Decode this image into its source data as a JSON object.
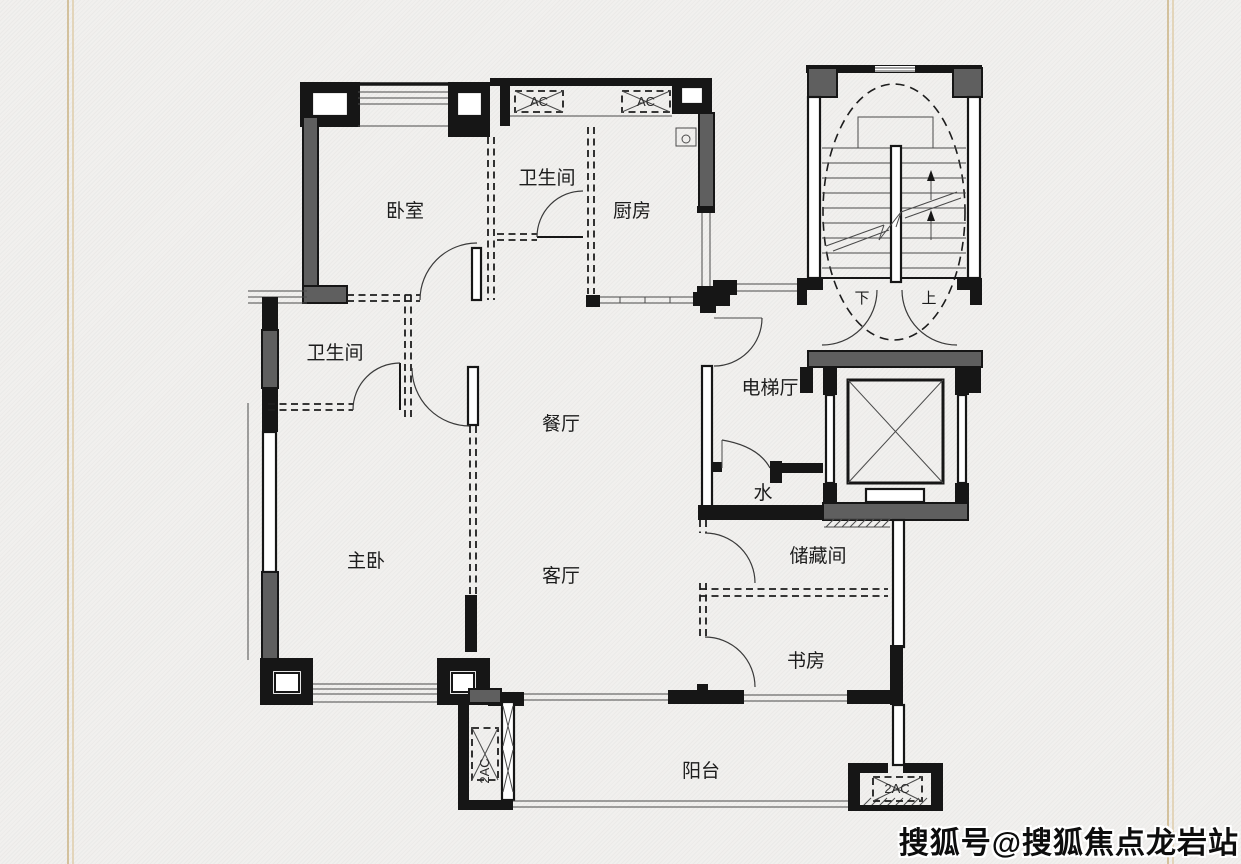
{
  "watermark": {
    "text": "搜狐号@搜狐焦点龙岩站"
  },
  "floorplan": {
    "rooms": {
      "bedroom": "卧室",
      "bathroom_top": "卫生间",
      "kitchen": "厨房",
      "bathroom_left": "卫生间",
      "dining_room": "餐厅",
      "elevator_hall": "电梯厅",
      "water_room": "水",
      "master_bedroom": "主卧",
      "living_room": "客厅",
      "storage_room": "储藏间",
      "study": "书房",
      "balcony": "阳台"
    },
    "stairs": {
      "down_label": "下",
      "up_label": "上"
    },
    "ac_labels": {
      "top_left": "AC",
      "top_right": "AC",
      "balcony_left": "2AC",
      "balcony_right": "2AC"
    },
    "colors": {
      "wall": "#161616",
      "shear_wall": "#5f5f5f",
      "paper": "#f1f0ee",
      "frame_line": "#d3c19d",
      "watermark_fill": "#0d0d0d"
    }
  }
}
